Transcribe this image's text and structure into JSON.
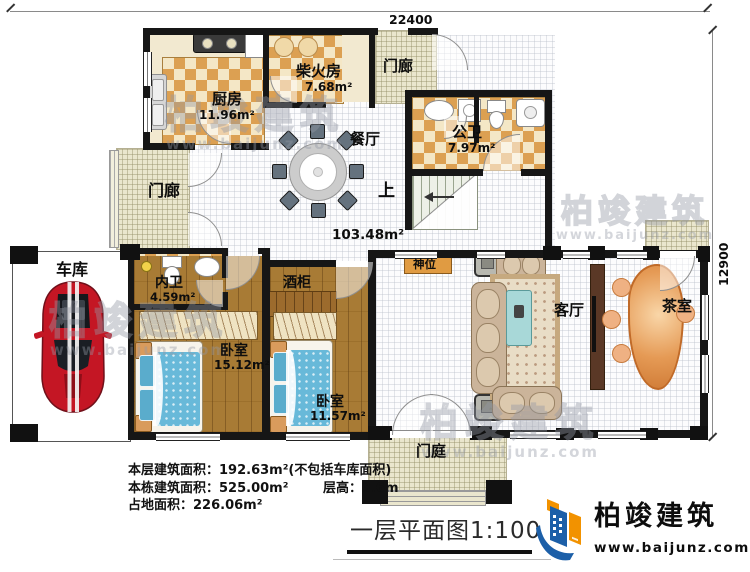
{
  "dimensions": {
    "top": "22400",
    "right": "12900"
  },
  "rooms": {
    "firewood": {
      "label": "柴火房",
      "area": "7.68m²"
    },
    "kitchen": {
      "label": "厨房",
      "area": "11.96m²"
    },
    "porch_top": {
      "label": "门廊"
    },
    "public_bath": {
      "label": "公卫",
      "area": "7.97m²"
    },
    "dining": {
      "label": "餐厅"
    },
    "stairs": {
      "label": "上"
    },
    "hall": {
      "area": "103.48m²"
    },
    "shrine": {
      "label": "神位"
    },
    "porch_left": {
      "label": "门廊"
    },
    "garage": {
      "label": "车库"
    },
    "inner_bath": {
      "label": "内卫",
      "area": "4.59m²"
    },
    "wine_cabinet": {
      "label": "酒柜"
    },
    "bedroom_big": {
      "label": "卧室",
      "area": "15.12m²"
    },
    "bedroom_small": {
      "label": "卧室",
      "area": "11.57m²"
    },
    "living": {
      "label": "客厅"
    },
    "tea": {
      "label": "茶室"
    },
    "entry_court": {
      "label": "门庭"
    }
  },
  "stats": {
    "floor_area": "本层建筑面积：192.63m²(不包括车库面积)",
    "total_area": "本栋建筑面积：525.00m²",
    "floor_height": "层高：3.6m",
    "land_area": "占地面积：226.06m²"
  },
  "title": "一层平面图1:100",
  "brand": {
    "name": "柏竣建筑",
    "url": "www.baijunz.com"
  },
  "watermark": {
    "name": "柏竣建筑",
    "url": "www.baijunz.com"
  },
  "colors": {
    "wall": "#161616",
    "tile_orange": "#dca052",
    "tile_cream": "#f4e7c6",
    "wood": "#a87b35",
    "bed_blue": "#68b9d9",
    "car_red": "#c41624",
    "brand_blue": "#1c5fa8",
    "brand_orange": "#f29200"
  }
}
